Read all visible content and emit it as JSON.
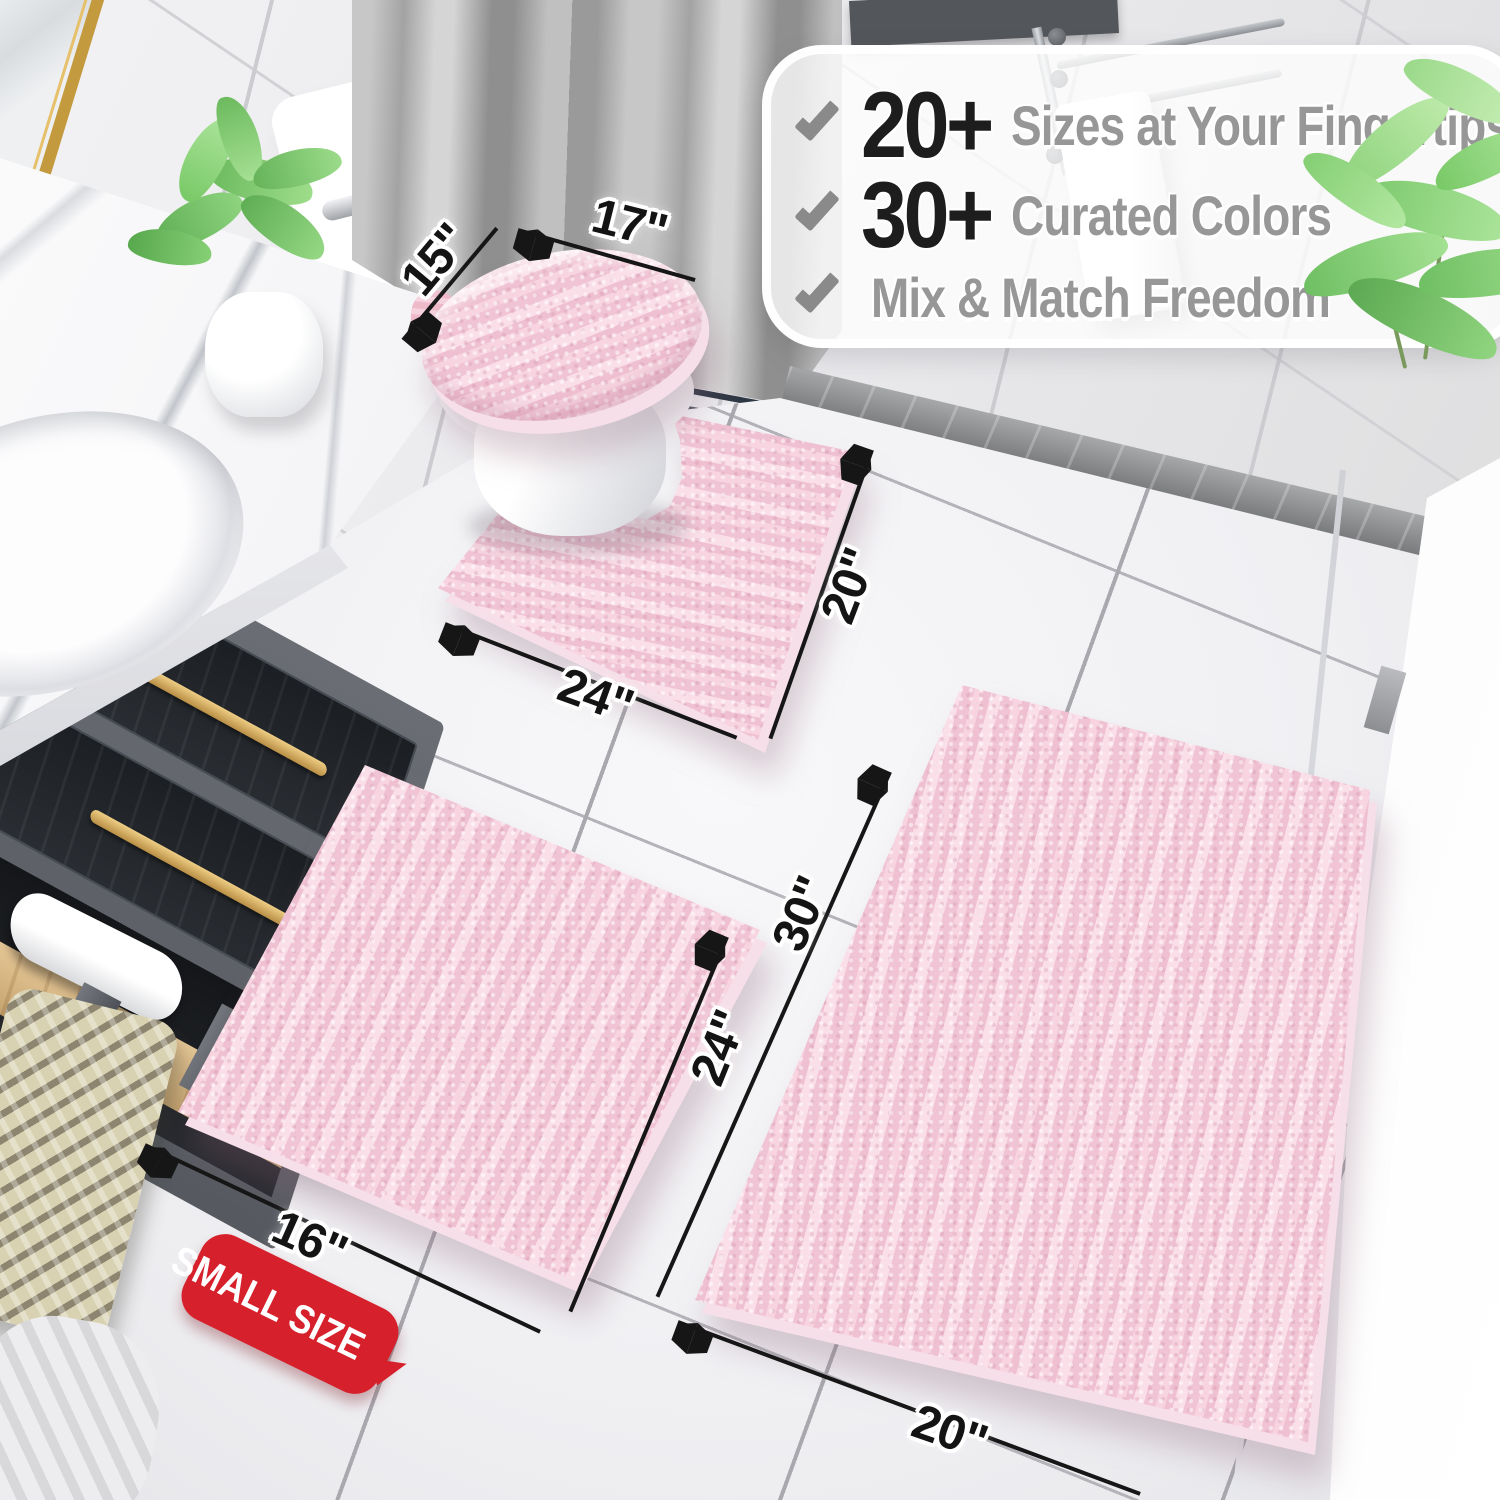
{
  "scene": {
    "description": "bathroom with pink chenille bath rug set"
  },
  "callout": {
    "items": [
      {
        "stat": "20+",
        "label": "Sizes at Your Fingertips"
      },
      {
        "stat": "30+",
        "label": "Curated Colors"
      },
      {
        "stat": "",
        "label": "Mix & Match Freedom"
      }
    ]
  },
  "dimensions": {
    "lid_cover": {
      "depth": "15\"",
      "width": "17\""
    },
    "contour_rug": {
      "width": "24\"",
      "depth": "20\""
    },
    "small_rug": {
      "width": "16\"",
      "length": "24\""
    },
    "large_rug": {
      "length": "30\"",
      "width": "20\""
    }
  },
  "badge": {
    "label": "SMALL SIZE"
  },
  "vanity": {
    "perfume_label": "MISQ"
  },
  "colors": {
    "rug_pink": "#f3c9d6",
    "badge_red": "#d6202b",
    "check_gray": "#8a8a8a",
    "stat_black": "#1d1d1d",
    "label_gray": "#979797",
    "arrow_black": "#161616",
    "wood_shelf": "#d9b98e",
    "brass_handle": "#c9a24b"
  }
}
